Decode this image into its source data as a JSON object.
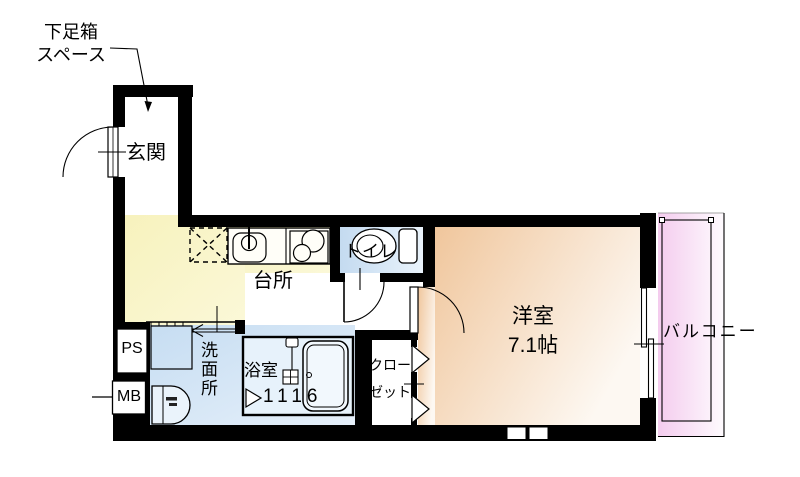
{
  "labels": {
    "shoe_box_space_line1": "下足箱",
    "shoe_box_space_line2": "スペース",
    "entrance": "玄関",
    "kitchen": "台所",
    "toilet": "トイレ",
    "western_room": "洋室",
    "western_room_size": "7.1帖",
    "balcony": "バルコニー",
    "washroom": "洗面所",
    "bathroom": "浴室",
    "bathroom_module_size": "1116",
    "closet_line1": "クロー",
    "closet_line2": "ゼット",
    "pipe_space": "PS",
    "meter_box": "MB"
  },
  "colors": {
    "wall": "#000000",
    "kitchen_floor": "#f8f4c6",
    "toilet_floor": "#c9def2",
    "washroom_floor": "#cde1f3",
    "bathroom_floor": "#e7f2fb",
    "western_room_floor": "#f1c89e",
    "balcony_floor": "#f5cdef"
  }
}
